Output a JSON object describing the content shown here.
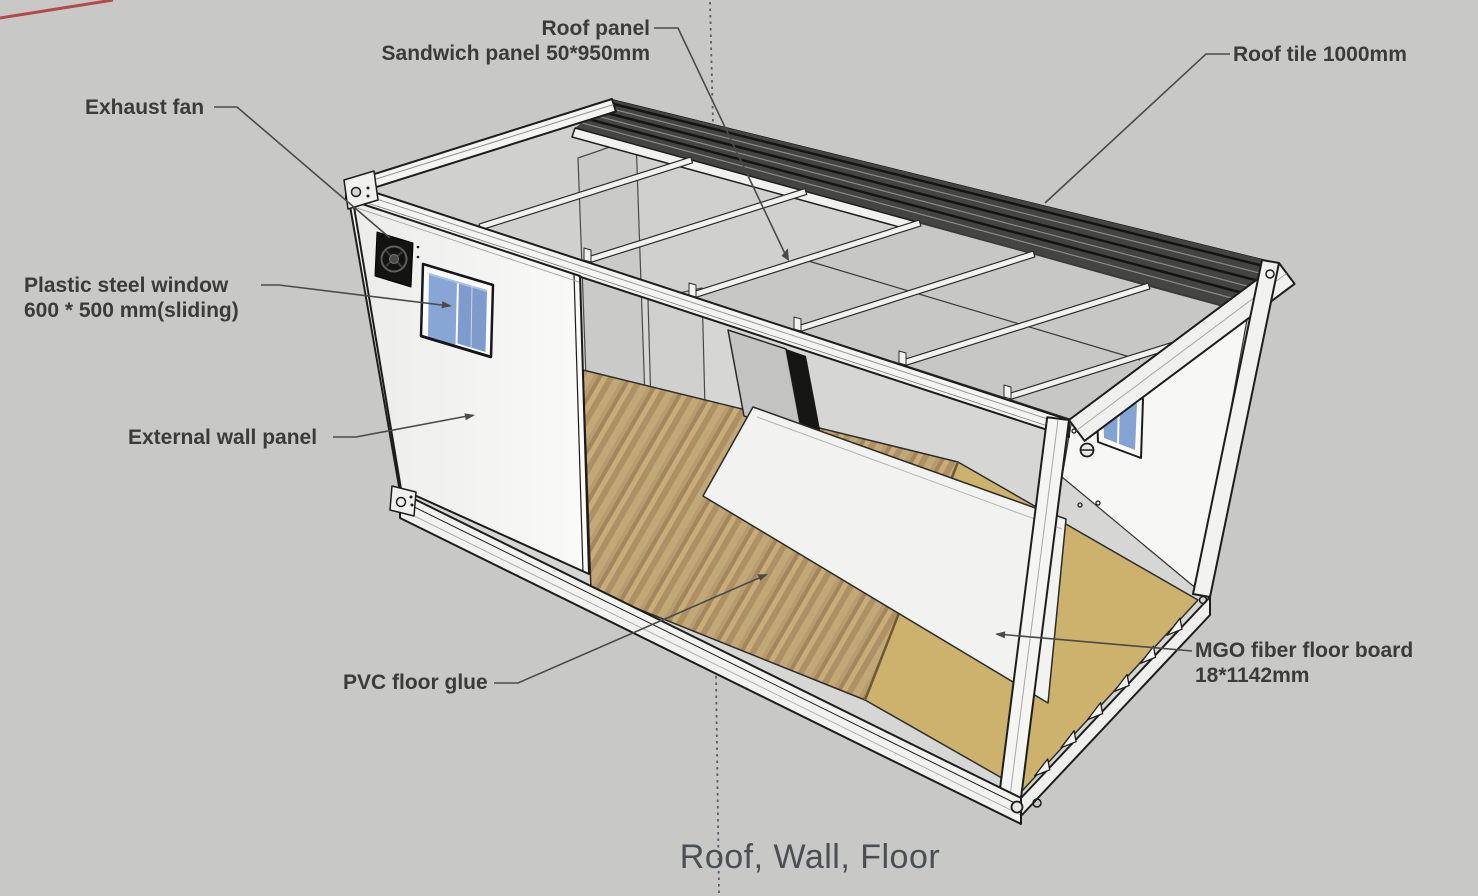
{
  "title": "Roof, Wall, Floor",
  "annotations": {
    "roof_panel": {
      "line1": "Roof panel",
      "line2": "Sandwich panel 50*950mm"
    },
    "roof_tile": {
      "line1": "Roof tile 1000mm"
    },
    "exhaust_fan": {
      "line1": "Exhaust fan"
    },
    "plastic_steel_window": {
      "line1": "Plastic steel window",
      "line2": "600 * 500 mm(sliding)"
    },
    "external_wall_panel": {
      "line1": "External wall panel"
    },
    "pvc_floor_glue": {
      "line1": "PVC floor glue"
    },
    "mgo_floor_board": {
      "line1": "MGO fiber floor board",
      "line2": "18*1142mm"
    }
  },
  "colors": {
    "background": "#c8c8c6",
    "label_text": "#3b3b3b",
    "title_text": "#4b4e53",
    "leader_line": "#4a4a48",
    "frame_white": "#f4f4f2",
    "outline": "#1d1d1b",
    "roof_tile_dark": "#444442",
    "ceiling_panel": "#c7c7c5",
    "wall_white": "#f7f7f5",
    "wood_floor": "#b89b6e",
    "mgo_board": "#cdb26e",
    "window_glass": "#87a6d6",
    "axis_red": "#b24a4c",
    "axis_blue": "#5c5c68"
  }
}
